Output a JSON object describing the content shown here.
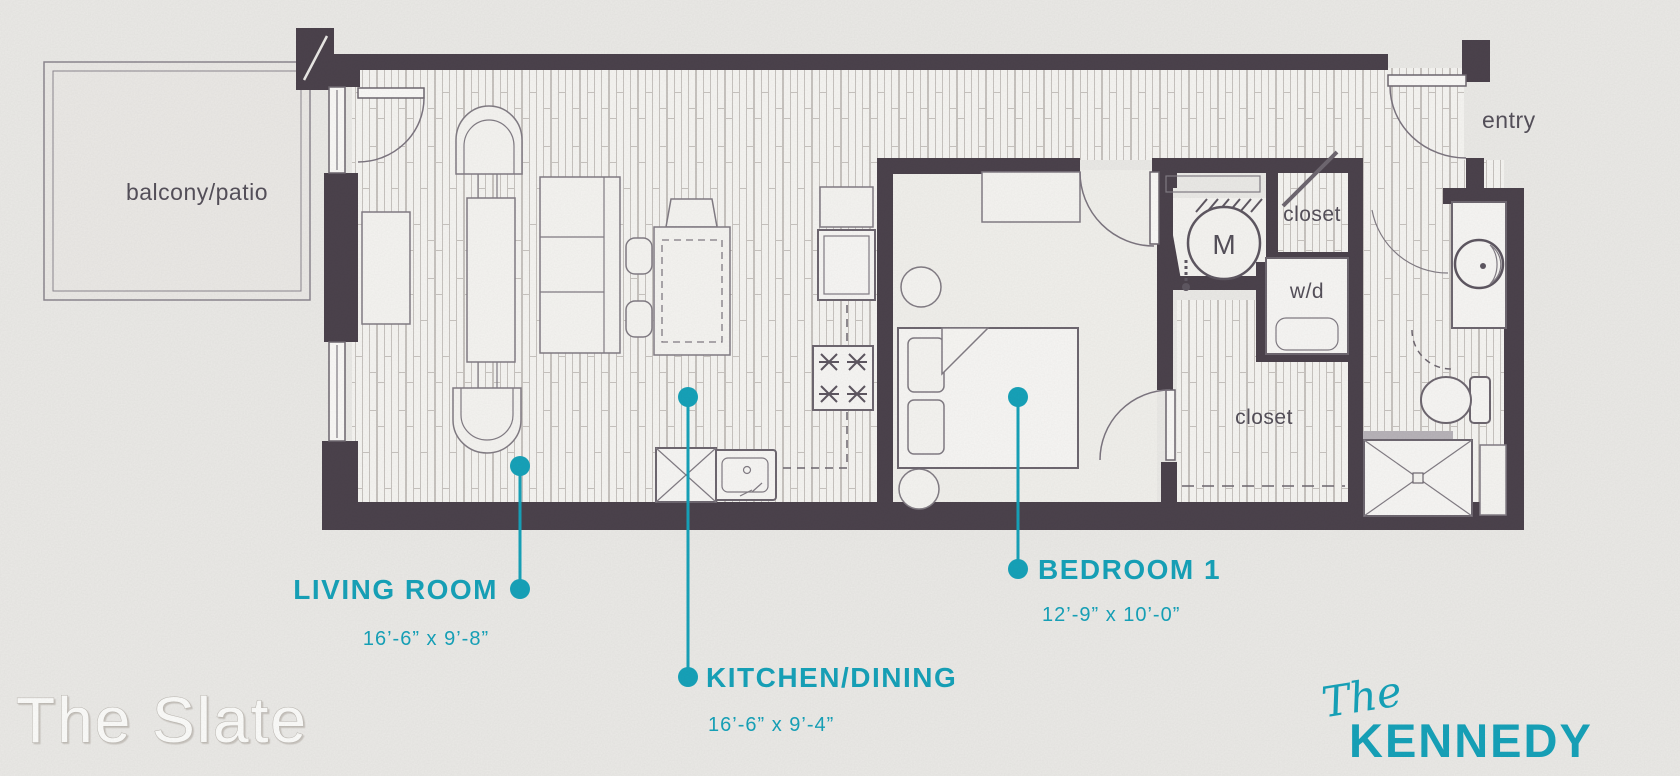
{
  "title": "The Kennedy floor plan",
  "colors": {
    "accent_teal": "#17a3ba",
    "wall": "#4c434d",
    "paper": "#ecebe8",
    "floor": "#f7f6f3",
    "label_gray": "#56515b"
  },
  "labels": {
    "balcony": "balcony/patio",
    "entry": "entry",
    "closet_top": "closet",
    "closet_bottom": "closet",
    "washer_dryer": "w/d",
    "mechanical": "M"
  },
  "callouts": {
    "living": {
      "name": "LIVING ROOM",
      "dims": "16’-6” x 9’-8”"
    },
    "kitchen": {
      "name": "KITCHEN/DINING",
      "dims": "16’-6” x 9’-4”"
    },
    "bedroom": {
      "name": "BEDROOM 1",
      "dims": "12’-9” x 10’-0”"
    }
  },
  "branding": {
    "watermark": "The Slate",
    "logo_script": "The",
    "logo_name": "KENNEDY"
  }
}
